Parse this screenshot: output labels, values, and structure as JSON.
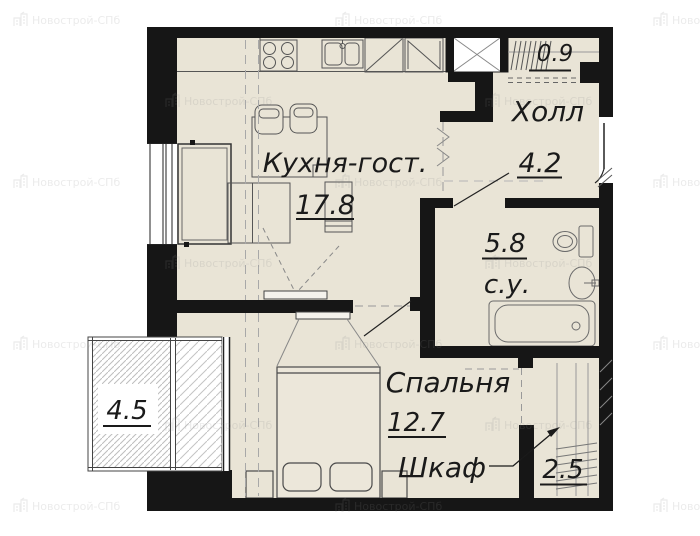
{
  "watermark": {
    "text": "Новострой-СПб"
  },
  "rooms": {
    "kitchen_living": {
      "name": "Кухня-гост.",
      "area": "17.8"
    },
    "hall": {
      "name": "Холл",
      "area": "4.2"
    },
    "bathroom": {
      "name": "с.у.",
      "area": "5.8"
    },
    "bedroom": {
      "name": "Спальня",
      "area": "12.7"
    },
    "wardrobe": {
      "name": "Шкаф",
      "area": "2.5"
    },
    "entry_storage": {
      "area": "0.9"
    },
    "balcony": {
      "area": "4.5"
    }
  },
  "colors": {
    "floor": "#e9e4d6",
    "wall": "#161616",
    "label": "#1a1a1a",
    "furniture_line": "#555555",
    "fixture_line": "#6a6a6a",
    "hatch": "#bdbdbd",
    "watermark": "#8a8a8a"
  }
}
